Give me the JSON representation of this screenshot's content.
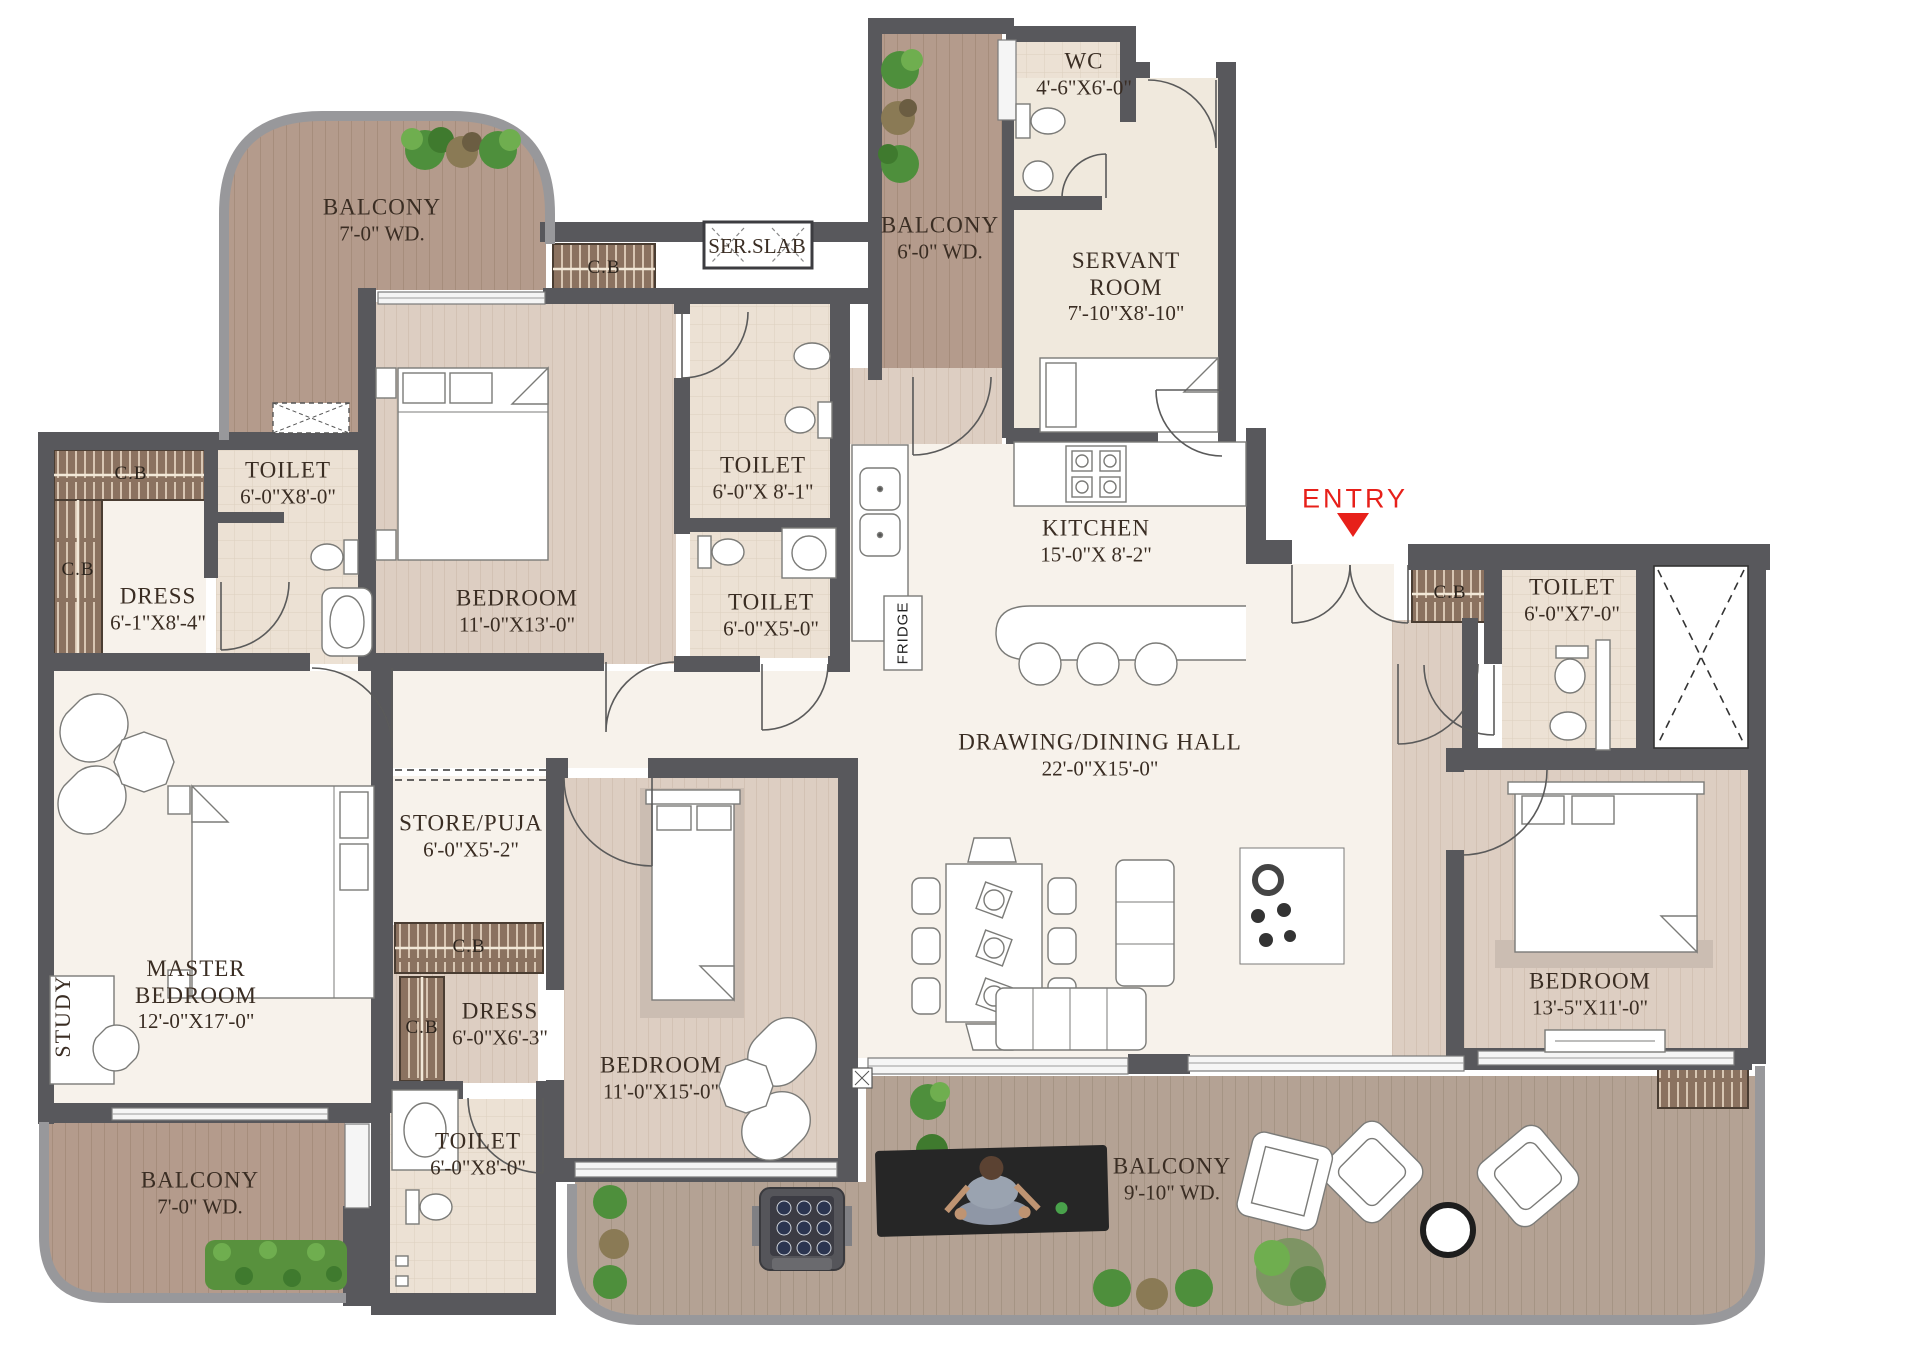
{
  "plan": {
    "type": "apartment-floor-plan",
    "entry_label": "ENTRY",
    "cupboard_label": "C.B",
    "colors": {
      "wall": "#58585c",
      "outer_balcony_wall": "#98989b",
      "marble_floor": "#f7f2eb",
      "tile_floor": "#ece1d4",
      "cream_floor": "#f0e9dd",
      "balcony_wood": "#b49b8c",
      "deck_wood": "#b4a294",
      "room_wood": "#ddcec2",
      "cupboard_wood": "#8b7260",
      "entry_red": "#e7201a",
      "label_text": "#3a2d23",
      "plant_green": "#4e8f3c"
    },
    "rooms": {
      "balcony_top_left": {
        "name": "BALCONY",
        "dims": "7'-0\" WD."
      },
      "ser_slab": {
        "name": "SER.SLAB"
      },
      "balcony_service": {
        "name": "BALCONY",
        "dims": "6'-0\" WD."
      },
      "wc": {
        "name": "WC",
        "dims": "4'-6\"X6'-0\""
      },
      "servant_room": {
        "name": "SERVANT",
        "name2": "ROOM",
        "dims": "7'-10\"X8'-10\""
      },
      "toilet_upper_left": {
        "name": "TOILET",
        "dims": "6'-0\"X8'-0\""
      },
      "dress_upper": {
        "name": "DRESS",
        "dims": "6'-1\"X8'-4\""
      },
      "bedroom_upper": {
        "name": "BEDROOM",
        "dims": "11'-0\"X13'-0\""
      },
      "toilet_mid": {
        "name": "TOILET",
        "dims": "6'-0\"X 8'-1\""
      },
      "toilet_small": {
        "name": "TOILET",
        "dims": "6'-0\"X5'-0\""
      },
      "kitchen": {
        "name": "KITCHEN",
        "dims": "15'-0\"X 8'-2\""
      },
      "toilet_right": {
        "name": "TOILET",
        "dims": "6'-0\"X7'-0\""
      },
      "hall": {
        "name": "DRAWING/DINING HALL",
        "dims": "22'-0\"X15'-0\""
      },
      "store_puja": {
        "name": "STORE/PUJA",
        "dims": "6'-0\"X5'-2\""
      },
      "dress_lower": {
        "name": "DRESS",
        "dims": "6'-0\"X6'-3\""
      },
      "master_bedroom": {
        "name": "MASTER",
        "name2": "BEDROOM",
        "dims": "12'-0\"X17'-0\""
      },
      "study": {
        "name": "STUDY"
      },
      "bedroom_lower": {
        "name": "BEDROOM",
        "dims": "11'-0\"X15'-0\""
      },
      "bedroom_right": {
        "name": "BEDROOM",
        "dims": "13'-5\"X11'-0\""
      },
      "toilet_bottom": {
        "name": "TOILET",
        "dims": "6'-0\"X8'-0\""
      },
      "balcony_bottom_left": {
        "name": "BALCONY",
        "dims": "7'-0\" WD."
      },
      "balcony_bottom": {
        "name": "BALCONY",
        "dims": "9'-10\" WD."
      },
      "fridge": {
        "name": "FRIDGE"
      }
    }
  }
}
